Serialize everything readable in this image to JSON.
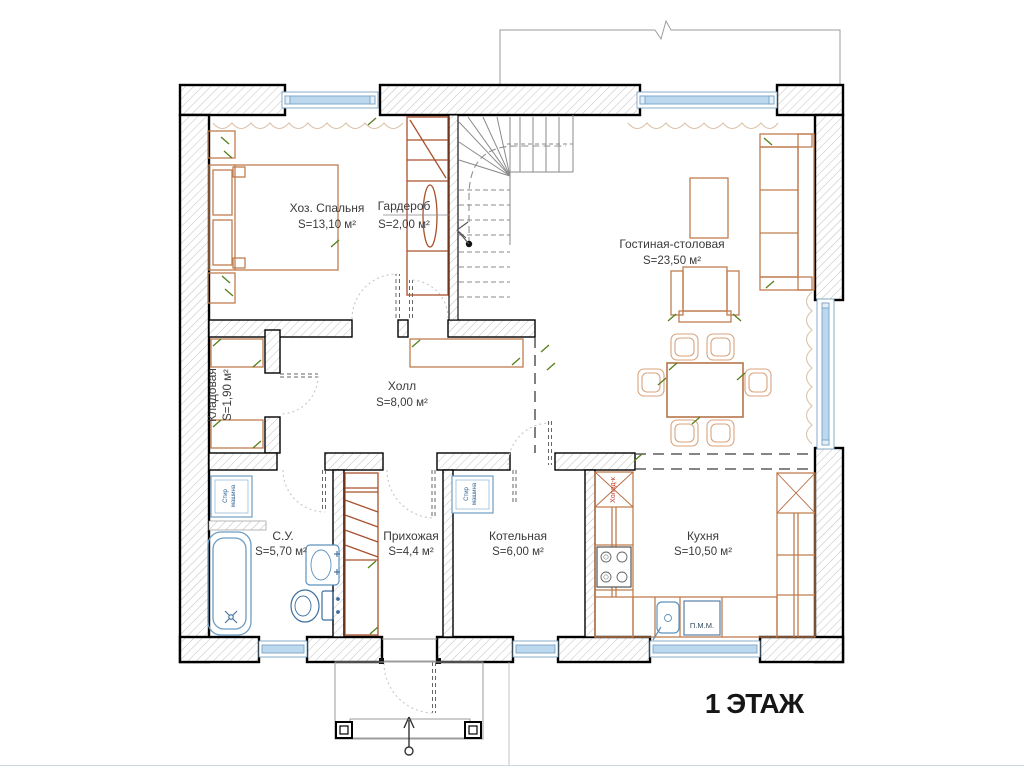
{
  "floor_label": "1 ЭТАЖ",
  "rooms": {
    "bedroom": {
      "name": "Хоз. Спальня",
      "area": "S=13,10 м²"
    },
    "wardrobe": {
      "name": "Гардероб",
      "area": "S=2,00 м²"
    },
    "living": {
      "name": "Гостиная-столовая",
      "area": "S=23,50 м²"
    },
    "storage": {
      "name": "Кладовая",
      "area": "S=1,90 м²"
    },
    "hall": {
      "name": "Холл",
      "area": "S=8,00 м²"
    },
    "bathroom": {
      "name": "С.У.",
      "area": "S=5,70 м²"
    },
    "entry": {
      "name": "Прихожая",
      "area": "S=4,4 м²"
    },
    "boiler": {
      "name": "Котельная",
      "area": "S=6,00 м²"
    },
    "kitchen": {
      "name": "Кухня",
      "area": "S=10,50 м²"
    }
  },
  "appliances": {
    "washer": {
      "line1": "Стир",
      "line2": "машина"
    },
    "fridge": "Холод-к",
    "dishwasher": "П.М.М."
  },
  "colors": {
    "wall_hatch": "#b0b0b0",
    "furniture": "#bf7d4e",
    "closet": "#a9502c",
    "fixture_blue": "#6b9cc3",
    "window_blue": "#bcd8ee",
    "tick_green": "#55801c"
  }
}
